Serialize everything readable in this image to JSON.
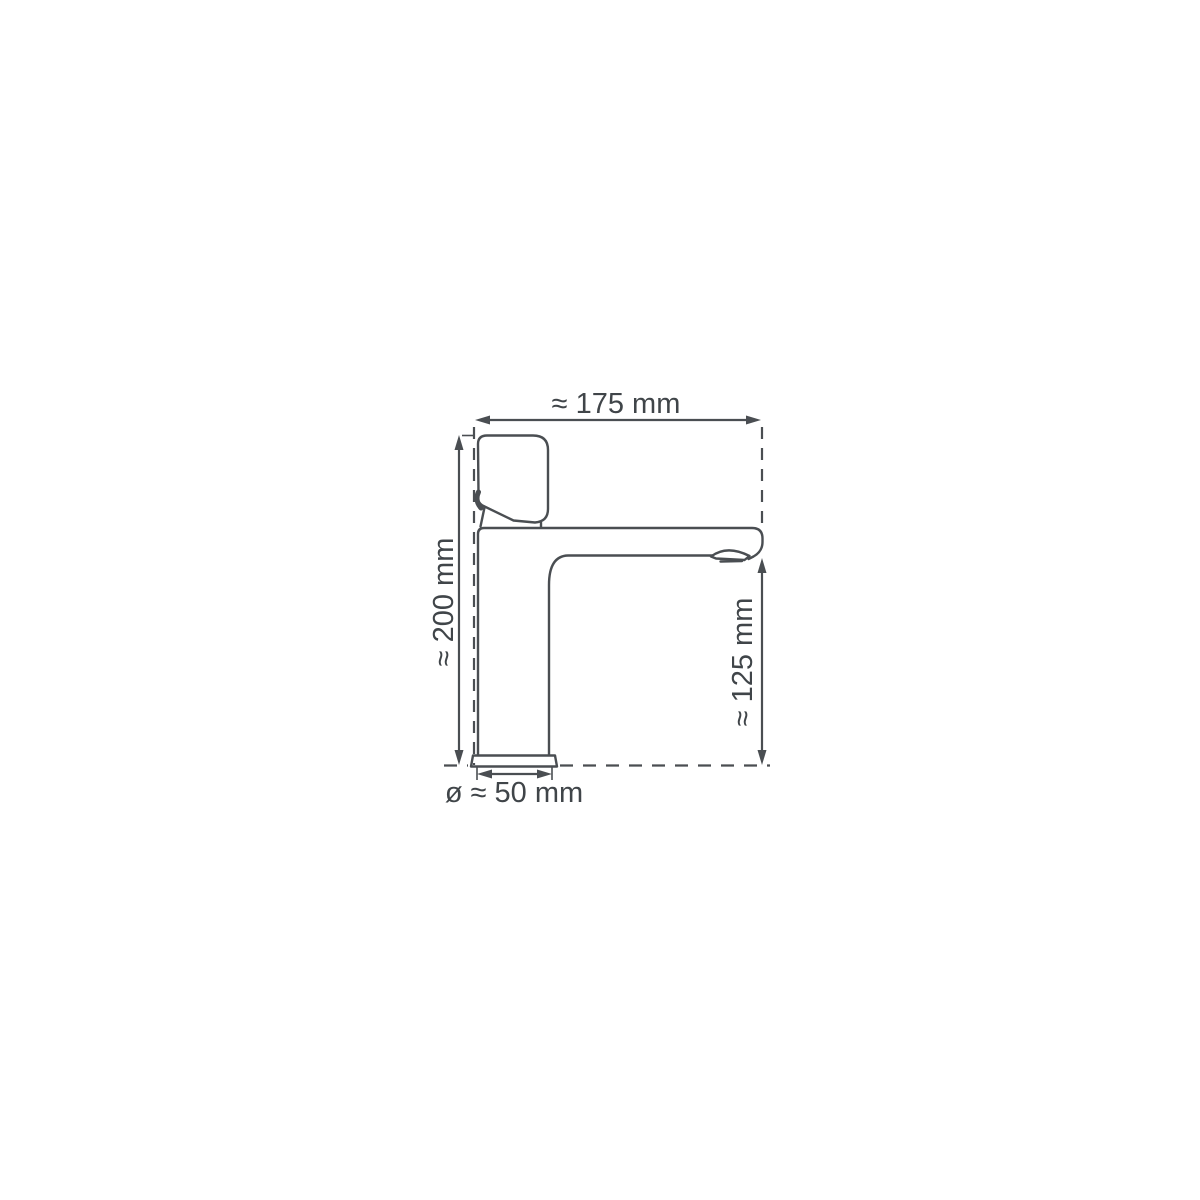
{
  "page": {
    "background_color": "#ffffff"
  },
  "diagram": {
    "kind": "technical-dimension-drawing",
    "subject": "single-lever basin mixer tap, side view",
    "stroke_color": "#4a4e52",
    "text_color": "#404549",
    "dimensions": {
      "total_width": "≈ 175 mm",
      "total_height": "≈ 200 mm",
      "spout_height": "≈ 125 mm",
      "base_diameter": "ø ≈ 50 mm"
    }
  }
}
